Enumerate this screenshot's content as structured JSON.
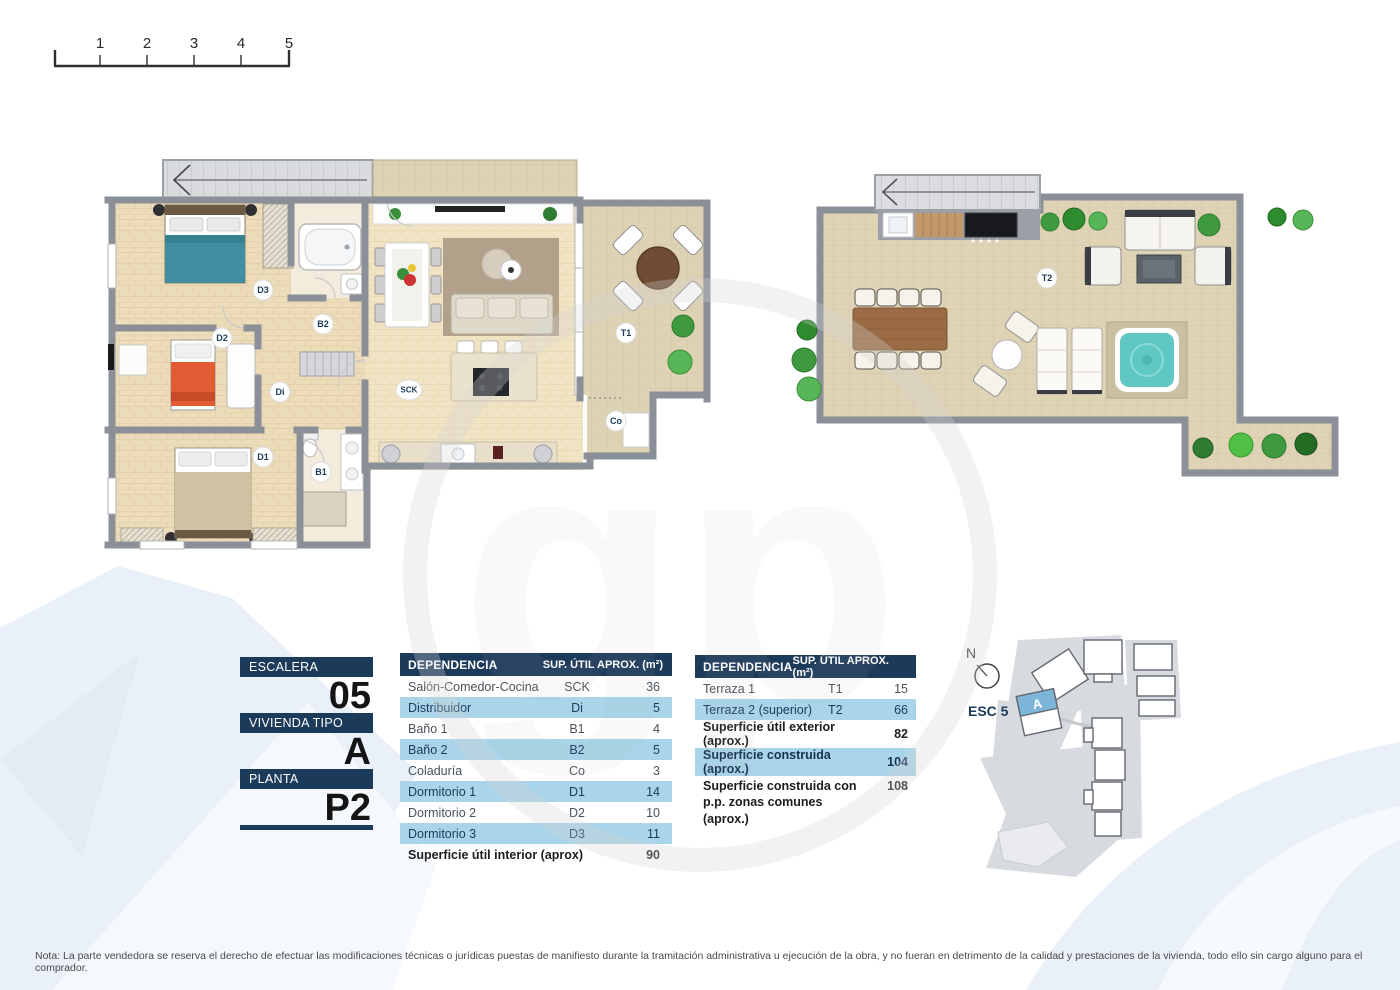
{
  "scale_bar": {
    "ticks": [
      "1",
      "2",
      "3",
      "4",
      "5"
    ]
  },
  "floor_plans": {
    "main": {
      "room_labels": {
        "d3": "D3",
        "b2": "B2",
        "d2": "D2",
        "di": "Di",
        "sck": "SCK",
        "d1": "D1",
        "b1": "B1",
        "co": "Co",
        "t1": "T1"
      }
    },
    "upper": {
      "room_labels": {
        "t2": "T2"
      }
    }
  },
  "info_panels": {
    "escalera": {
      "label": "ESCALERA",
      "value": "05"
    },
    "vivienda": {
      "label": "VIVIENDA TIPO",
      "value": "A"
    },
    "planta": {
      "label": "PLANTA",
      "value": "P2"
    }
  },
  "interior_table": {
    "header": {
      "col1": "DEPENDENCIA",
      "col2": "SUP. ÚTIL APROX. (m²)"
    },
    "rows": [
      {
        "name": "Salón-Comedor-Cocina",
        "code": "SCK",
        "value": "36"
      },
      {
        "name": "Distribuidor",
        "code": "Di",
        "value": "5"
      },
      {
        "name": "Baño 1",
        "code": "B1",
        "value": "4"
      },
      {
        "name": "Baño 2",
        "code": "B2",
        "value": "5"
      },
      {
        "name": "Coladuría",
        "code": "Co",
        "value": "3"
      },
      {
        "name": "Dormitorio 1",
        "code": "D1",
        "value": "14"
      },
      {
        "name": "Dormitorio 2",
        "code": "D2",
        "value": "10"
      },
      {
        "name": "Dormitorio 3",
        "code": "D3",
        "value": "11"
      }
    ],
    "footer": {
      "name": "Superficie útil interior (aprox)",
      "value": "90"
    }
  },
  "exterior_table": {
    "header": {
      "col1": "DEPENDENCIA",
      "col2": "SUP. ÚTIL APROX. (m²)"
    },
    "rows": [
      {
        "name": "Terraza 1",
        "code": "T1",
        "value": "15"
      },
      {
        "name": "Terraza 2 (superior)",
        "code": "T2",
        "value": "66"
      }
    ],
    "summary_rows": [
      {
        "name": "Superficie útil exterior (aprox.)",
        "value": "82"
      },
      {
        "name": "Superficie construida (aprox.)",
        "value": "104"
      },
      {
        "name": "Superficie construida con p.p. zonas comunes (aprox.)",
        "value": "108"
      }
    ]
  },
  "site_plan": {
    "north_label": "N",
    "esc_label": "ESC 5",
    "unit_label": "A"
  },
  "note": "Nota: La parte vendedora se reserva el derecho de efectuar las modificaciones técnicas o jurídicas puestas de manifiesto durante la tramitación administrativa u ejecución de la obra, y no fueran en detrimento de la calidad y prestaciones de la vivienda, todo ello sin cargo alguno para el comprador.",
  "colors": {
    "navy": "#1c3a5a",
    "light_blue_row": "#a9d4e9",
    "unit_blue": "#7db6d9",
    "hot_tub_teal": "#5fc8c2"
  }
}
